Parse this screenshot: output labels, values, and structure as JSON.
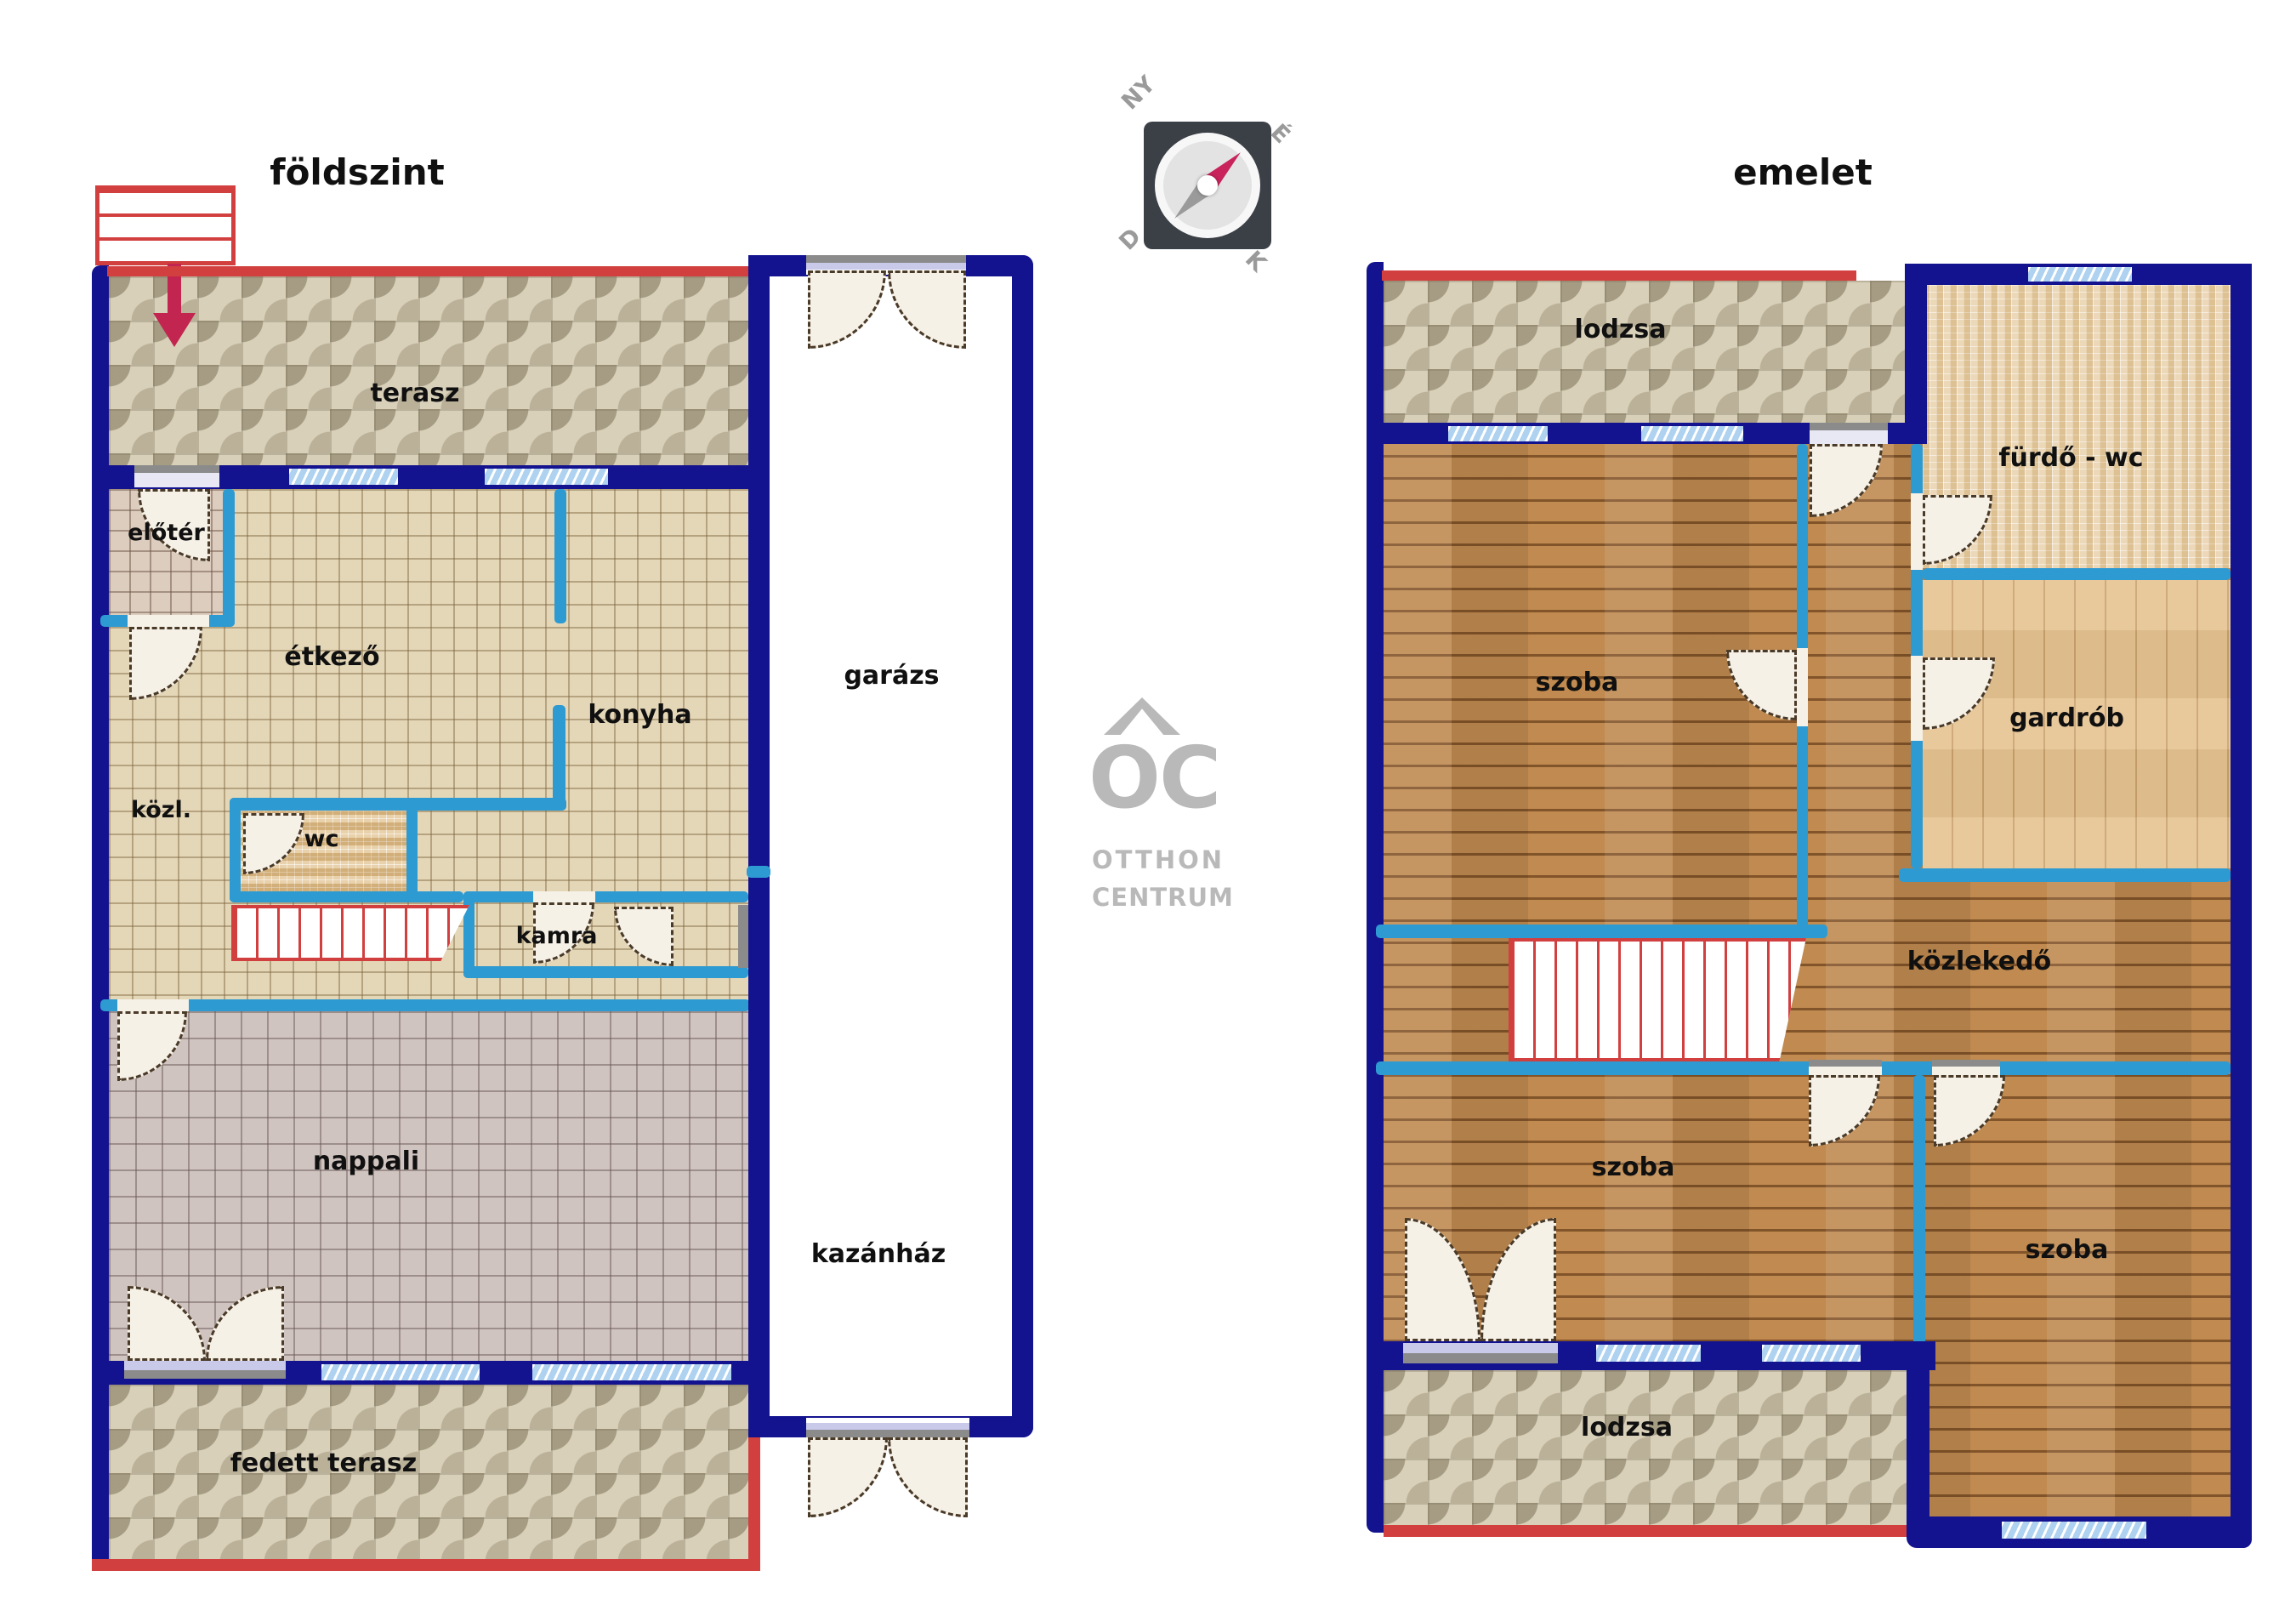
{
  "titles": {
    "ground": "földszint",
    "upper": "emelet"
  },
  "compass": {
    "nw": "NY",
    "ne": "É",
    "sw": "D",
    "se": "K"
  },
  "logo": {
    "mark": "OC",
    "line1": "OTTHON",
    "line2": "CENTRUM"
  },
  "colors": {
    "exterior_wall": "#14138f",
    "partition_wall": "#2d9ad2",
    "accent_red": "#d23f3f",
    "entry_arrow": "#c2254f",
    "window_fill": "#aed2f0",
    "label_text": "#101010",
    "logo_gray": "#b9b9b9"
  },
  "ground_floor": {
    "terasz": "terasz",
    "eloter": "előtér",
    "etkezo": "étkező",
    "konyha": "konyha",
    "kozl": "közl.",
    "wc": "wc",
    "kamra": "kamra",
    "nappali": "nappali",
    "garazs": "garázs",
    "kazanhaz": "kazánház",
    "fedett_terasz": "fedett terasz"
  },
  "upper_floor": {
    "lodzsa_top": "lodzsa",
    "furdo": "fürdő - wc",
    "szoba_top": "szoba",
    "gardrob": "gardrób",
    "kozlekedo": "közlekedő",
    "szoba_mid": "szoba",
    "szoba_right": "szoba",
    "lodzsa_bottom": "lodzsa"
  }
}
